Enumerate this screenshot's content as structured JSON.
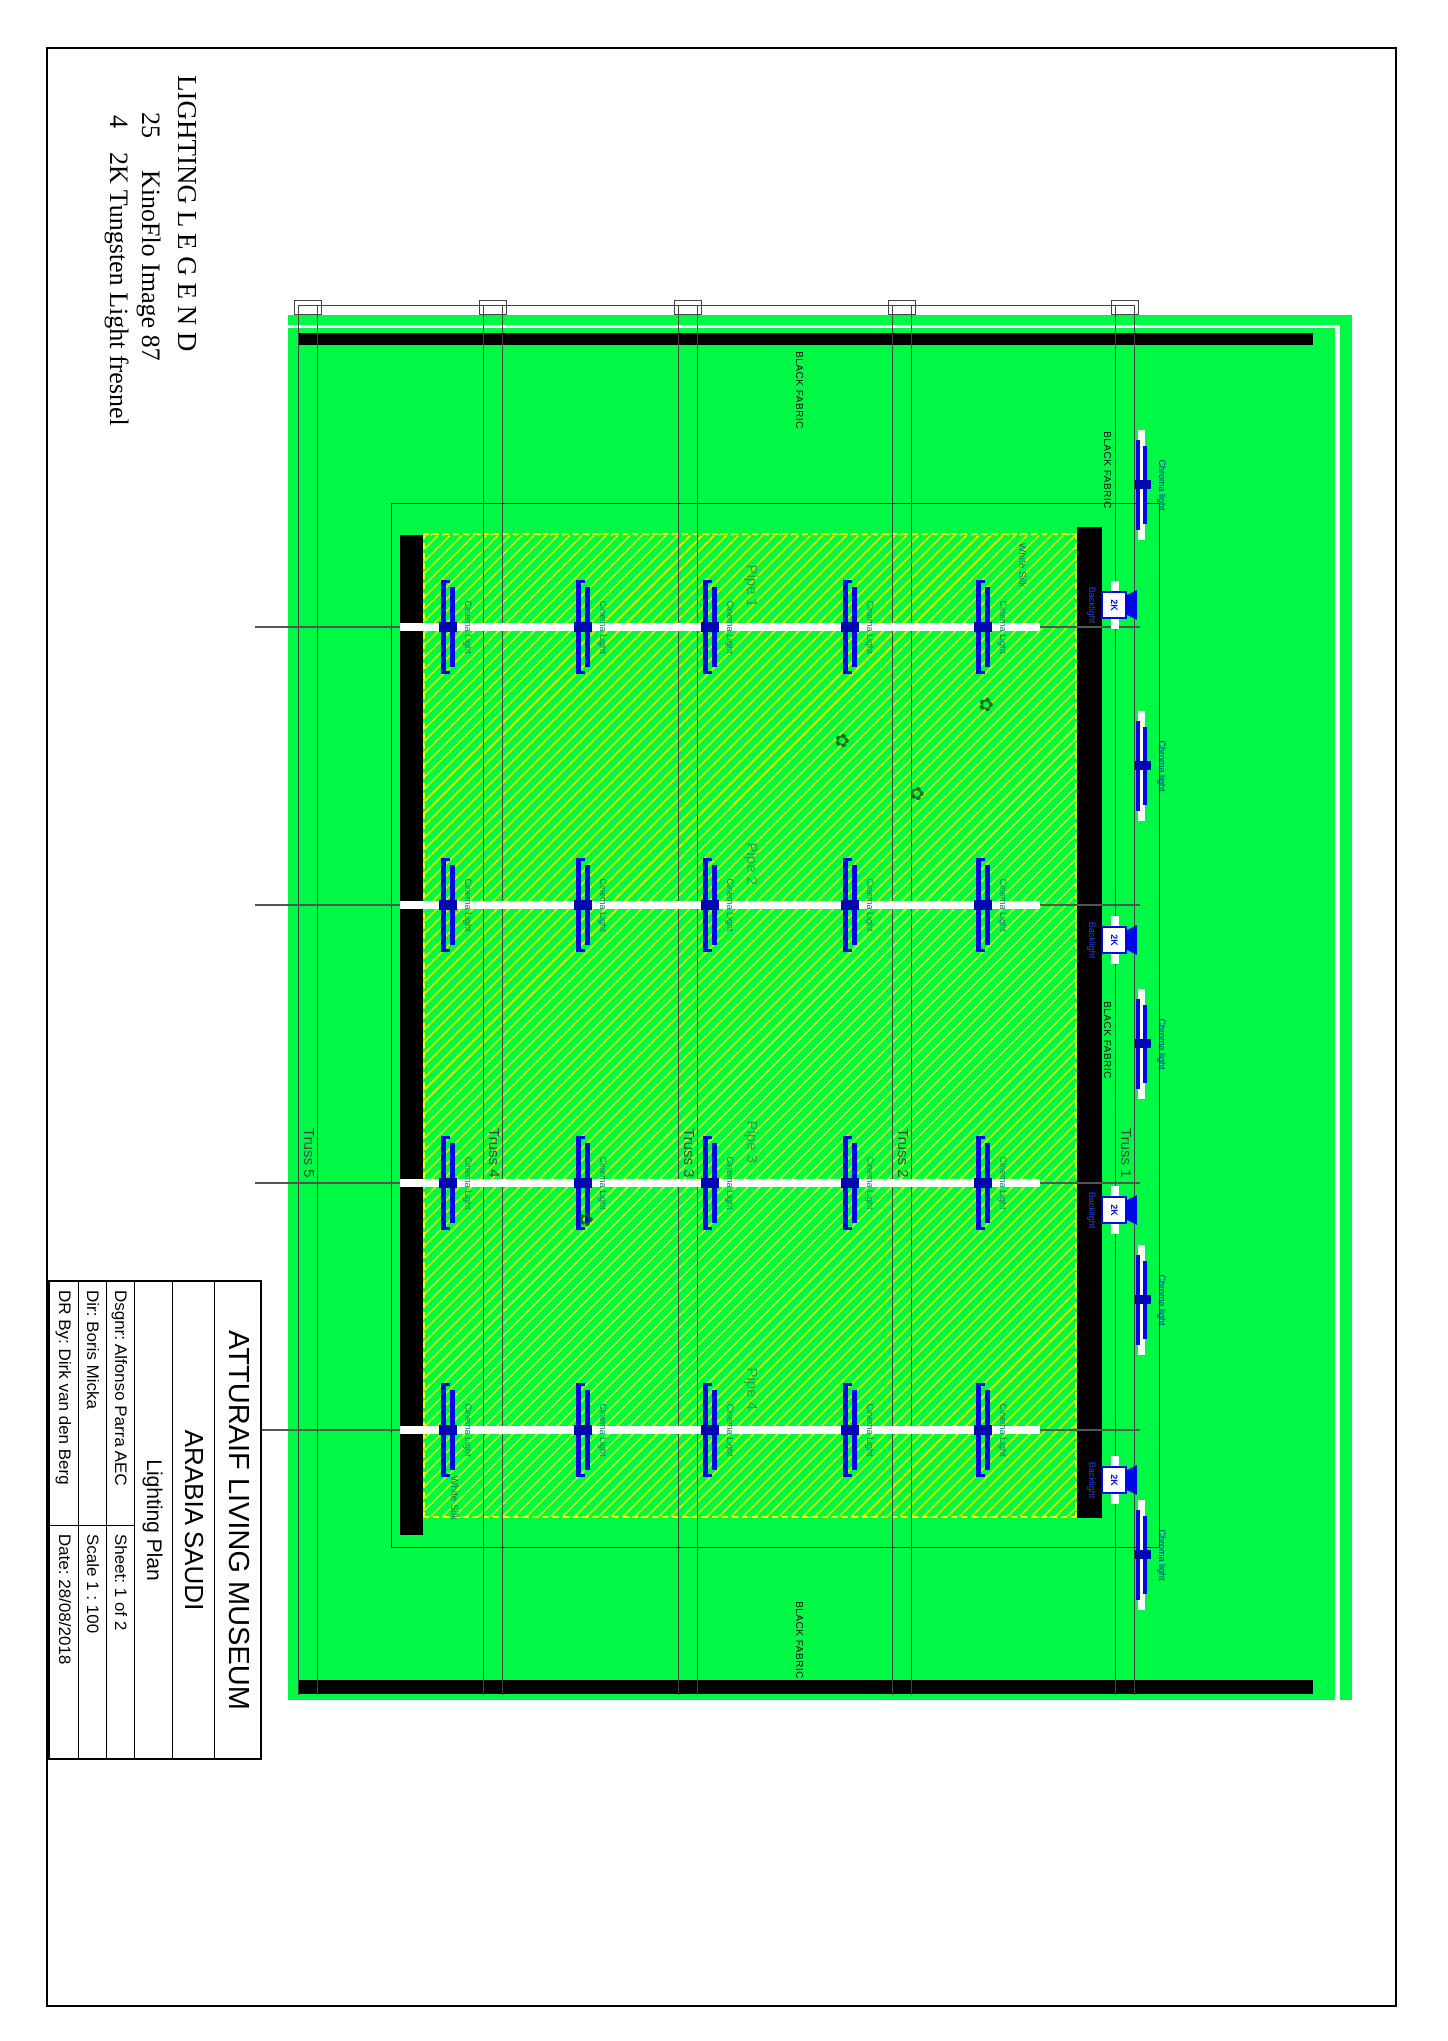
{
  "legend": {
    "title": "LIGHTING  L E G E N D",
    "items": [
      {
        "qty": "25",
        "desc": "KinoFlo Image 87"
      },
      {
        "qty": "4",
        "desc": "2K Tungsten Light fresnel"
      }
    ]
  },
  "title_block": {
    "project": "ATTURAIF LIVING MUSEUM",
    "location": "ARABIA SAUDI",
    "drawing": "Lighting Plan",
    "fields": [
      {
        "label": "Dsgnr: Alfonso Parra AEC",
        "value": "Sheet: 1 of 2"
      },
      {
        "label": "Dir: Boris Micka",
        "value": "Scale 1 : 100"
      },
      {
        "label": "DR By: Dirk van den Berg",
        "value": "Date: 28/08/2018"
      }
    ]
  },
  "plan": {
    "colors": {
      "green": "#00f944",
      "fixture_blue": "#0008e8"
    },
    "labels": {
      "black_fabric": "BLACK FABRIC",
      "white_silk": "White Silk",
      "kino_fixture": "Cinema Light",
      "chroma_fixture": "Chroma light",
      "fresnel": "2K",
      "backlight": "Backlight"
    },
    "trusses": [
      {
        "name": "Truss 1",
        "y": 313
      },
      {
        "name": "Truss 2",
        "y": 536
      },
      {
        "name": "Truss 3",
        "y": 750
      },
      {
        "name": "Truss 4",
        "y": 945
      },
      {
        "name": "Truss 5",
        "y": 1130
      }
    ],
    "pipes": [
      {
        "name": "Pipe 1",
        "x": 627
      },
      {
        "name": "Pipe 2",
        "x": 905
      },
      {
        "name": "Pipe 3",
        "x": 1183
      },
      {
        "name": "Pipe 4",
        "x": 1430
      }
    ],
    "fixture_rows": [
      465,
      598,
      738,
      865,
      1000
    ],
    "chroma_x": [
      485,
      766,
      1044,
      1300,
      1555
    ],
    "fresnel_x": [
      605,
      940,
      1210,
      1480
    ],
    "black_fabric_positions": [
      {
        "x": 390,
        "y": 644
      },
      {
        "x": 470,
        "y": 336
      },
      {
        "x": 1040,
        "y": 336
      },
      {
        "x": 1640,
        "y": 644
      }
    ],
    "white_silk_positions": [
      {
        "x": 565,
        "y": 421
      },
      {
        "x": 1498,
        "y": 989
      }
    ],
    "clouds": [
      {
        "x": 697,
        "y": 452
      },
      {
        "x": 733,
        "y": 596
      },
      {
        "x": 786,
        "y": 521
      },
      {
        "x": 1212,
        "y": 852
      }
    ]
  }
}
